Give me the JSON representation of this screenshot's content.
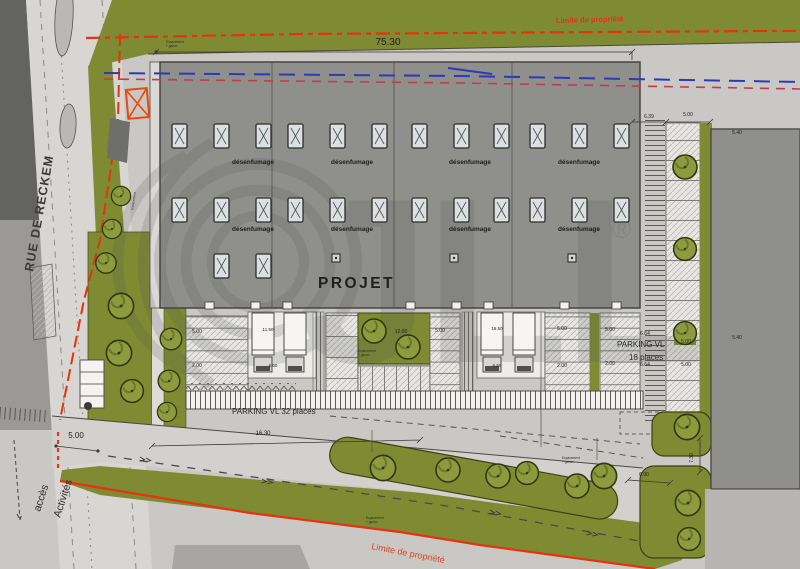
{
  "plan": {
    "street_name": "RUE DE RECKEM",
    "project_label": "PROJET",
    "smoke_vent_label": "désenfumage",
    "property_limit_top": "Limite de propriété",
    "property_limit_bottom": "Limite de propriété",
    "parking_main_label": "PARKING VL 32 places",
    "parking_side_line1": "PARKING VL",
    "parking_side_line2": "18 places",
    "access_line1": "accès",
    "access_line2": "Activités",
    "green_note_line1": "Espacement",
    "green_note_line2": "+ gazon"
  },
  "dimensions": {
    "building_width": "75.30",
    "access_width": "5.00",
    "d500": "5.00",
    "d639": "6.39",
    "d540": "5.40",
    "d664": "6.64",
    "d200": "2.00",
    "d660": "6.60",
    "d730": "7.30",
    "d690": "6.90",
    "d1630": "16.30",
    "d1200": "12.00",
    "d1150": "11.50",
    "d1650": "16.50"
  },
  "watermark": {
    "letters": "JLL",
    "registered": "®"
  },
  "colors": {
    "green": "#7e8b33",
    "red": "#e5330f",
    "blue": "#3038b8",
    "magenta": "#c43a55",
    "building": "#8f8f8c",
    "road": "#d7d6d2",
    "site": "#c9c8c4",
    "dark": "#646461"
  }
}
